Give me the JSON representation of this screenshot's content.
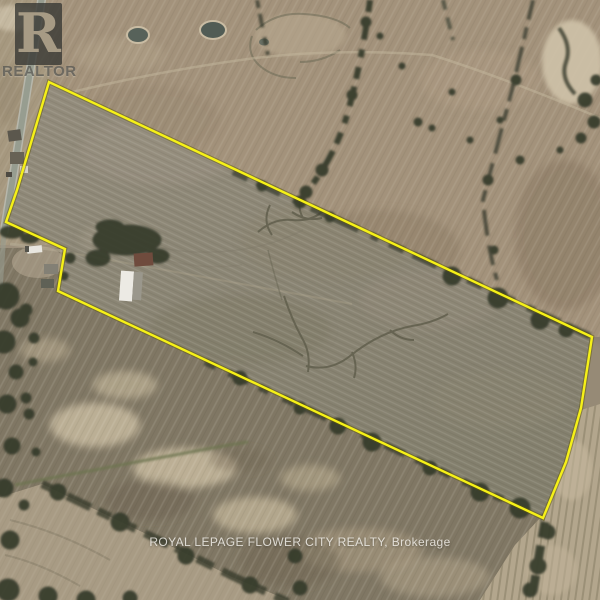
{
  "watermarks": {
    "realtor_logo_letter": "R",
    "realtor_logo_label": "REALTOR",
    "brokerage": "ROYAL LEPAGE FLOWER CITY REALTY, Brokerage"
  },
  "map": {
    "kind": "aerial-satellite-photo",
    "boundary_color": "#f6f117",
    "parcel_points": "49,82 17,190 6,222 65,249 58,291 543,518 566,462 581,408 592,337",
    "features": [
      "rural-road-west-side",
      "farmstead-with-white-barn",
      "two-ponds-north",
      "hedgerow-tree-lines",
      "plowed-farm-fields",
      "drainage-creek-marks"
    ]
  }
}
